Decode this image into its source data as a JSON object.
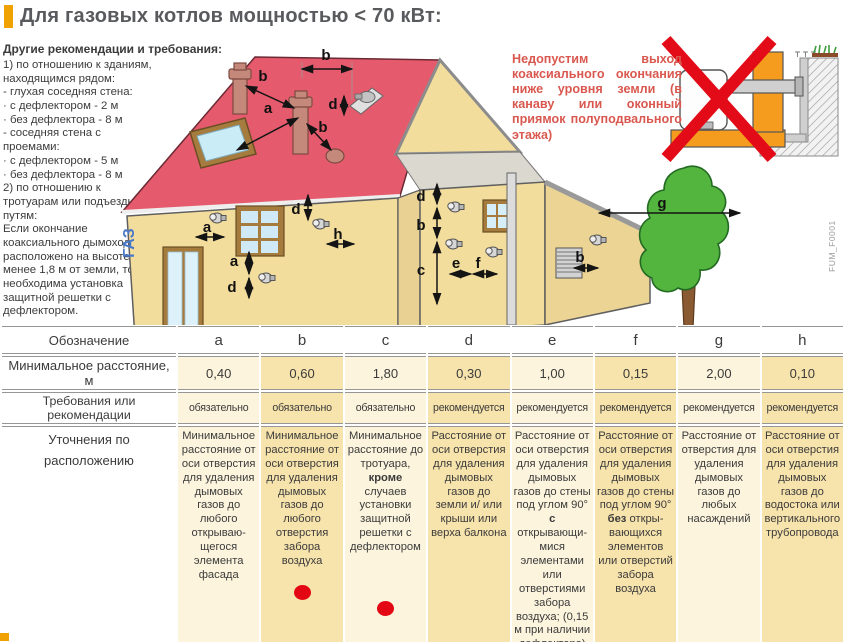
{
  "page": {
    "title": "Для газовых котлов мощностью < 70 кВт:",
    "subtitle": "Другие рекомендации и требования:"
  },
  "left_notes": "1) по отношению к зданиям, находящимся рядом:\n- глухая соседняя стена:\n· с дефлектором - 2 м\n· без дефлектора - 8 м\n- соседняя стена с проемами:\n· с дефлектором - 5 м\n· без дефлектора - 8 м\n2) по отношению к тротуарам или подъездным путям:\nЕсли окончание коаксиального дымохода расположено на высоте менее 1,8 м от земли, то необходима установка защитной решетки с дефлектором.",
  "warning_text": "Недопустим выход коаксиального окончания ниже уровня земли (в канаву или оконный приямок полуподвального этажа)",
  "diagram": {
    "gas_label": "ГАЗ",
    "figure_code": "FUM_F0001",
    "dimension_labels": [
      {
        "t": "b",
        "lx": 326,
        "ly": 24,
        "x1": 302,
        "y1": 33,
        "x2": 352,
        "y2": 33
      },
      {
        "t": "b",
        "lx": 263,
        "ly": 45,
        "x1": 246,
        "y1": 50,
        "x2": 294,
        "y2": 72
      },
      {
        "t": "a",
        "lx": 268,
        "ly": 77,
        "x1": 237,
        "y1": 114,
        "x2": 298,
        "y2": 82
      },
      {
        "t": "b",
        "lx": 323,
        "ly": 96,
        "x1": 307,
        "y1": 88,
        "x2": 331,
        "y2": 114
      },
      {
        "t": "d",
        "lx": 333,
        "ly": 73,
        "x1": 344,
        "y1": 60,
        "x2": 344,
        "y2": 79
      },
      {
        "t": "a",
        "lx": 207,
        "ly": 196,
        "x1": 196,
        "y1": 201,
        "x2": 224,
        "y2": 201
      },
      {
        "t": "d",
        "lx": 296,
        "ly": 178,
        "x1": 308,
        "y1": 159,
        "x2": 308,
        "y2": 184
      },
      {
        "t": "h",
        "lx": 338,
        "ly": 203,
        "x1": 327,
        "y1": 208,
        "x2": 354,
        "y2": 208
      },
      {
        "t": "a",
        "lx": 234,
        "ly": 230,
        "x1": 249,
        "y1": 216,
        "x2": 249,
        "y2": 238
      },
      {
        "t": "d",
        "lx": 232,
        "ly": 256,
        "x1": 249,
        "y1": 242,
        "x2": 249,
        "y2": 262
      },
      {
        "t": "d",
        "lx": 421,
        "ly": 165,
        "x1": 437,
        "y1": 148,
        "x2": 437,
        "y2": 168
      },
      {
        "t": "b",
        "lx": 421,
        "ly": 194,
        "x1": 437,
        "y1": 172,
        "x2": 437,
        "y2": 202
      },
      {
        "t": "c",
        "lx": 421,
        "ly": 239,
        "x1": 437,
        "y1": 206,
        "x2": 437,
        "y2": 268
      },
      {
        "t": "e",
        "lx": 456,
        "ly": 232,
        "x1": 450,
        "y1": 238,
        "x2": 471,
        "y2": 238
      },
      {
        "t": "f",
        "lx": 478,
        "ly": 232,
        "x1": 473,
        "y1": 238,
        "x2": 497,
        "y2": 238
      },
      {
        "t": "b",
        "lx": 580,
        "ly": 226,
        "x1": 574,
        "y1": 232,
        "x2": 598,
        "y2": 232
      },
      {
        "t": "g",
        "lx": 662,
        "ly": 172,
        "x1": 599,
        "y1": 177,
        "x2": 740,
        "y2": 177
      }
    ],
    "vents": [
      {
        "x": 217,
        "y": 182
      },
      {
        "x": 320,
        "y": 188
      },
      {
        "x": 266,
        "y": 242
      },
      {
        "x": 455,
        "y": 171
      },
      {
        "x": 453,
        "y": 208
      },
      {
        "x": 493,
        "y": 216
      },
      {
        "x": 597,
        "y": 204
      }
    ]
  },
  "table": {
    "rows": [
      {
        "label": "Обозначение",
        "cells": [
          "a",
          "b",
          "c",
          "d",
          "e",
          "f",
          "g",
          "h"
        ]
      },
      {
        "label": "Минимальное расстояние, м",
        "cells": [
          "0,40",
          "0,60",
          "1,80",
          "0,30",
          "1,00",
          "0,15",
          "2,00",
          "0,10"
        ]
      },
      {
        "label": "Требования или рекомендации",
        "cells": [
          "обязательно",
          "обязательно",
          "обязательно",
          "рекомендуется",
          "рекомендуется",
          "рекомендуется",
          "рекомендуется",
          "рекомендуется"
        ]
      },
      {
        "label": "Уточнения по расположению",
        "cells": [
          {
            "text": "Минимальное расстояние от оси отверстия для удаления дымовых газов до любого открываю­щегося элемента фасада"
          },
          {
            "text": "Минимальное расстояние от оси отверстия для удаления дымовых газов до любого отверстия забора воздуха",
            "dot": true,
            "dot_offset": 16
          },
          {
            "text": "Минимальное расстояние до тротуа­ра, **кроме** случаев установки защитной решетки с дефлектором",
            "dot": true,
            "dot_offset": 46
          },
          {
            "text": "Расстояние от оси отверстия для удаления дымовых газов до земли и/ или крыши или верха балкона"
          },
          {
            "text": "Расстояние от оси отверстия для удаления дымовых газов до стены под углом 90° **с** открывающи­мися элементами или отверстиями забора воздуха; (0,15 м при наличии дефлектора)"
          },
          {
            "text": "Расстояние от оси отверстия для удаления дымовых газов до стены под углом 90° **без** откры­вающихся элементов или отверстий забора воздуха"
          },
          {
            "text": "Расстояние от отверстия для удаления дымовых газов до любых насаждений"
          },
          {
            "text": "Расстояние от оси отверстия для удаления дымовых газов до водостока или вертикаль­ного трубопро­вода"
          }
        ]
      }
    ]
  },
  "colors": {
    "accent_orange": "#f0a202",
    "warning_red": "#d9584f",
    "red_dot": "#e30613",
    "roof_red": "#e55b6d",
    "wall_beige": "#f3dd9d",
    "cell_light": "#fcf4dd",
    "cell_dark": "#f7e3ac",
    "tree_green": "#53b43e",
    "gas_blue": "#4b79c9",
    "forbidden_wall_orange": "#f59c1e"
  }
}
